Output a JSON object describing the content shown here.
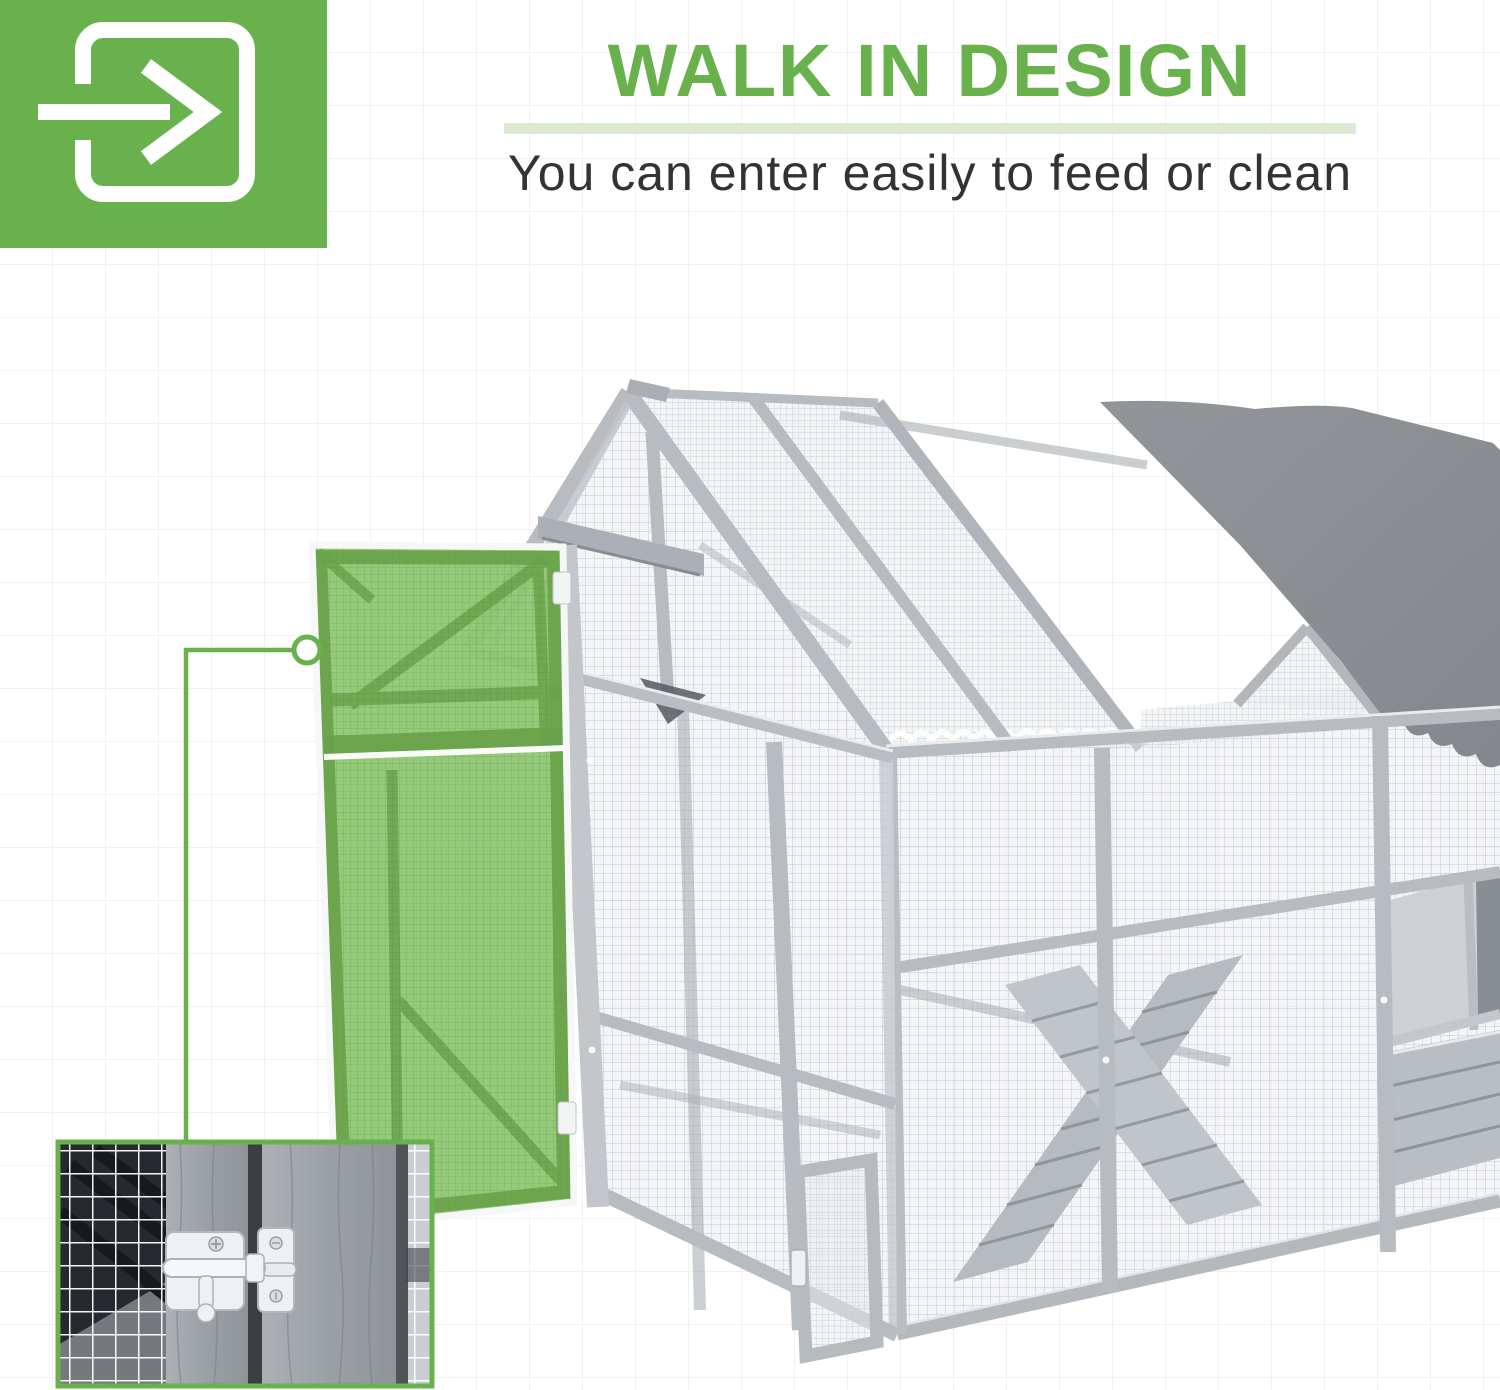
{
  "header": {
    "icon": "enter-door-arrow-icon",
    "title": "WALK IN DESIGN",
    "subtitle": "You can enter easily to feed or clean"
  },
  "colors": {
    "accent": "#68b14c",
    "accent-soft": "#dcead3",
    "text": "#333333",
    "door-green": "#8cc56f",
    "door-green-dark": "#68a24a",
    "frame": "#b7bcc1",
    "frame-dark": "#9aa0a6",
    "mesh-line": "#c8cdd2",
    "tarp": "#8b8f93",
    "wood": "#9aa0a5",
    "inset-dark": "#26292d",
    "latch": "#eef0f1",
    "grid": "#f4f0f0"
  }
}
